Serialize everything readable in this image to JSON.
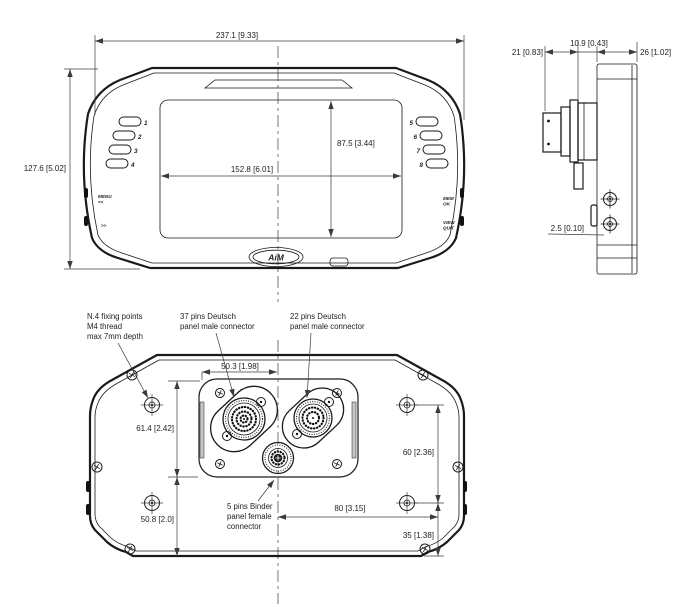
{
  "front": {
    "dim_width": "237.1 [9.33]",
    "dim_height": "127.6 [5.02]",
    "dim_screen_w": "152.8 [6.01]",
    "dim_screen_h": "87.5 [3.44]",
    "buttons_left": [
      "1",
      "2",
      "3",
      "4"
    ],
    "buttons_right": [
      "5",
      "6",
      "7",
      "8"
    ],
    "label_left_top": [
      "MENU",
      "<<"
    ],
    "label_left_bottom": ">>",
    "label_right_top": [
      "MEM",
      "OK"
    ],
    "label_right_bottom": [
      "VIEW",
      "QUIT"
    ],
    "logo": "AiM"
  },
  "side": {
    "dim_back": "21 [0.83]",
    "dim_mid": "10.9 [0.43]",
    "dim_body": "26 [1.02]",
    "dim_tab": "2.5 [0.10]"
  },
  "rear": {
    "dim_conn_offset": "50.3 [1.98]",
    "dim_fix_upper": "61.4 [2.42]",
    "dim_fix_lower": "50.8 [2.0]",
    "dim_fix_right_v": "60 [2.36]",
    "dim_fix_right_h": "80 [3.15]",
    "dim_fix_bottom": "35 [1.38]",
    "note_fixing": [
      "N.4 fixing points",
      "M4 thread",
      "max 7mm depth"
    ],
    "note_deutsch37": [
      "37 pins Deutsch",
      "panel male connector"
    ],
    "note_deutsch22": [
      "22 pins Deutsch",
      "panel male connector"
    ],
    "note_binder": [
      "5 pins Binder",
      "panel female",
      "connector"
    ]
  },
  "colors": {
    "line": "#1a1a1a",
    "dim": "#3b3b3b",
    "text": "#222222",
    "bg": "#ffffff"
  }
}
